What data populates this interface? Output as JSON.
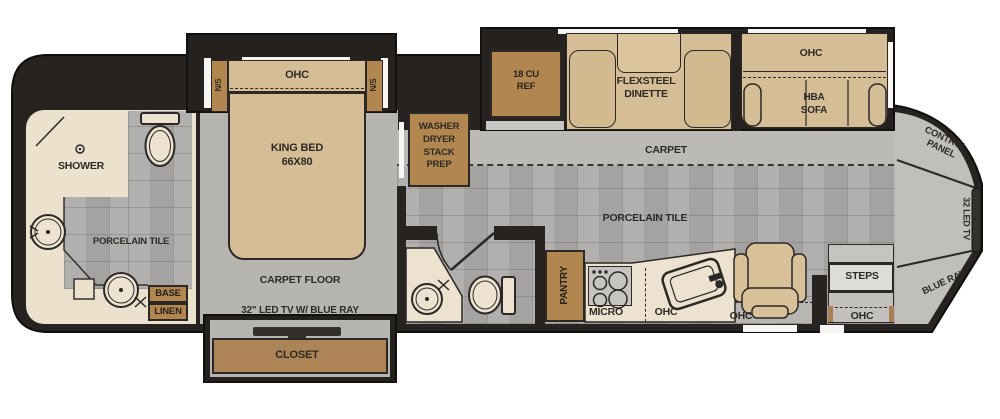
{
  "diagram": {
    "type": "rv-floorplan-top-view"
  },
  "colors": {
    "wall": "#262320",
    "slide_box": "#24211e",
    "porcelain_tile": "#aeacaa",
    "carpet": "#bcbab7",
    "bedroom_carpet": "#b7b5b2",
    "furniture_tan": "#d5bd96",
    "cabinet_brown": "#b1874f",
    "counter_cream": "#ece2cf"
  },
  "rear_bath": {
    "shower": "SHOWER",
    "floor": "PORCELAIN TILE",
    "base": "BASE",
    "linen": "LINEN"
  },
  "bedroom": {
    "nightstand": "N/S",
    "overhead": "OHC",
    "bed1": "KING BED",
    "bed2": "66X80",
    "floor": "CARPET FLOOR",
    "tv": "32\" LED TV W/ BLUE RAY",
    "closet": "CLOSET",
    "washer_prep": [
      "WASHER",
      "DRYER",
      "STACK",
      "PREP"
    ]
  },
  "galley": {
    "fridge": [
      "18 CU",
      "REF"
    ],
    "dinette": [
      "FLEXSTEEL",
      "DINETTE"
    ],
    "pantry": "PANTRY",
    "micro": "MICRO",
    "overhead": "OHC"
  },
  "living": {
    "overhead": "OHC",
    "sofa": [
      "HBA",
      "SOFA"
    ],
    "carpet": "CARPET",
    "floor": "PORCELAIN TILE"
  },
  "cab": {
    "overhead": "OHC",
    "steps": "STEPS",
    "steps_overhead": "OHC",
    "control_panel": [
      "CONTROL",
      "PANEL"
    ],
    "tv": "32 LED TV",
    "blue_ray": "BLUE RAY"
  }
}
